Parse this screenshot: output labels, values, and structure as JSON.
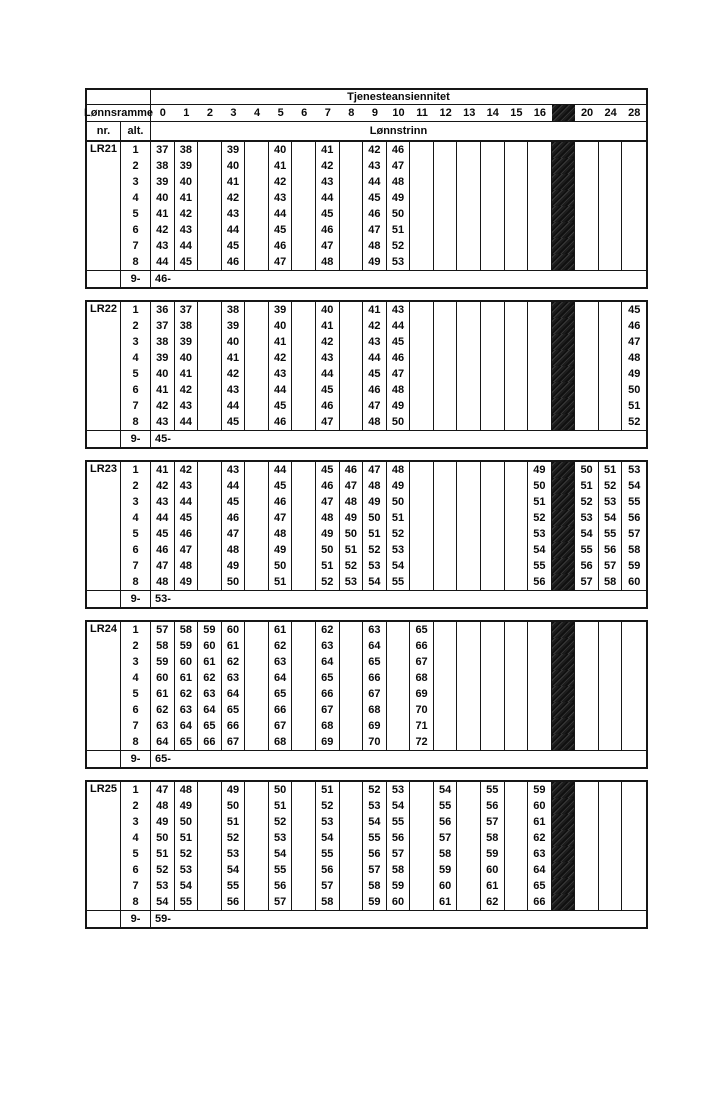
{
  "header": {
    "seniority_label": "Tjenesteansiennitet",
    "lonnsramme_label": "Lønnsramme",
    "nr_label": "nr.",
    "alt_label": "alt.",
    "lonnstrinn_label": "Lønnstrinn",
    "black_column_index": 17,
    "columns": [
      "0",
      "1",
      "2",
      "3",
      "4",
      "5",
      "6",
      "7",
      "8",
      "9",
      "10",
      "11",
      "12",
      "13",
      "14",
      "15",
      "16",
      "",
      "20",
      "24",
      "28"
    ]
  },
  "accent_colors": {
    "line": "#161616",
    "blocked_column_fill": "#1b1b1b",
    "paper": "#ffffff"
  },
  "blocks": [
    {
      "label": "LR21",
      "footer_alt": "9-",
      "footer_value": "46-",
      "rows": [
        {
          "alt": "1",
          "cells": [
            "37",
            "38",
            "",
            "39",
            "",
            "40",
            "",
            "41",
            "",
            "42",
            "46",
            "",
            "",
            "",
            "",
            "",
            "",
            "",
            "",
            "",
            ""
          ]
        },
        {
          "alt": "2",
          "cells": [
            "38",
            "39",
            "",
            "40",
            "",
            "41",
            "",
            "42",
            "",
            "43",
            "47",
            "",
            "",
            "",
            "",
            "",
            "",
            "",
            "",
            "",
            ""
          ]
        },
        {
          "alt": "3",
          "cells": [
            "39",
            "40",
            "",
            "41",
            "",
            "42",
            "",
            "43",
            "",
            "44",
            "48",
            "",
            "",
            "",
            "",
            "",
            "",
            "",
            "",
            "",
            ""
          ]
        },
        {
          "alt": "4",
          "cells": [
            "40",
            "41",
            "",
            "42",
            "",
            "43",
            "",
            "44",
            "",
            "45",
            "49",
            "",
            "",
            "",
            "",
            "",
            "",
            "",
            "",
            "",
            ""
          ]
        },
        {
          "alt": "5",
          "cells": [
            "41",
            "42",
            "",
            "43",
            "",
            "44",
            "",
            "45",
            "",
            "46",
            "50",
            "",
            "",
            "",
            "",
            "",
            "",
            "",
            "",
            "",
            ""
          ]
        },
        {
          "alt": "6",
          "cells": [
            "42",
            "43",
            "",
            "44",
            "",
            "45",
            "",
            "46",
            "",
            "47",
            "51",
            "",
            "",
            "",
            "",
            "",
            "",
            "",
            "",
            "",
            ""
          ]
        },
        {
          "alt": "7",
          "cells": [
            "43",
            "44",
            "",
            "45",
            "",
            "46",
            "",
            "47",
            "",
            "48",
            "52",
            "",
            "",
            "",
            "",
            "",
            "",
            "",
            "",
            "",
            ""
          ]
        },
        {
          "alt": "8",
          "cells": [
            "44",
            "45",
            "",
            "46",
            "",
            "47",
            "",
            "48",
            "",
            "49",
            "53",
            "",
            "",
            "",
            "",
            "",
            "",
            "",
            "",
            "",
            ""
          ]
        }
      ]
    },
    {
      "label": "LR22",
      "footer_alt": "9-",
      "footer_value": "45-",
      "rows": [
        {
          "alt": "1",
          "cells": [
            "36",
            "37",
            "",
            "38",
            "",
            "39",
            "",
            "40",
            "",
            "41",
            "43",
            "",
            "",
            "",
            "",
            "",
            "",
            "",
            "",
            "",
            "45"
          ]
        },
        {
          "alt": "2",
          "cells": [
            "37",
            "38",
            "",
            "39",
            "",
            "40",
            "",
            "41",
            "",
            "42",
            "44",
            "",
            "",
            "",
            "",
            "",
            "",
            "",
            "",
            "",
            "46"
          ]
        },
        {
          "alt": "3",
          "cells": [
            "38",
            "39",
            "",
            "40",
            "",
            "41",
            "",
            "42",
            "",
            "43",
            "45",
            "",
            "",
            "",
            "",
            "",
            "",
            "",
            "",
            "",
            "47"
          ]
        },
        {
          "alt": "4",
          "cells": [
            "39",
            "40",
            "",
            "41",
            "",
            "42",
            "",
            "43",
            "",
            "44",
            "46",
            "",
            "",
            "",
            "",
            "",
            "",
            "",
            "",
            "",
            "48"
          ]
        },
        {
          "alt": "5",
          "cells": [
            "40",
            "41",
            "",
            "42",
            "",
            "43",
            "",
            "44",
            "",
            "45",
            "47",
            "",
            "",
            "",
            "",
            "",
            "",
            "",
            "",
            "",
            "49"
          ]
        },
        {
          "alt": "6",
          "cells": [
            "41",
            "42",
            "",
            "43",
            "",
            "44",
            "",
            "45",
            "",
            "46",
            "48",
            "",
            "",
            "",
            "",
            "",
            "",
            "",
            "",
            "",
            "50"
          ]
        },
        {
          "alt": "7",
          "cells": [
            "42",
            "43",
            "",
            "44",
            "",
            "45",
            "",
            "46",
            "",
            "47",
            "49",
            "",
            "",
            "",
            "",
            "",
            "",
            "",
            "",
            "",
            "51"
          ]
        },
        {
          "alt": "8",
          "cells": [
            "43",
            "44",
            "",
            "45",
            "",
            "46",
            "",
            "47",
            "",
            "48",
            "50",
            "",
            "",
            "",
            "",
            "",
            "",
            "",
            "",
            "",
            "52"
          ]
        }
      ]
    },
    {
      "label": "LR23",
      "footer_alt": "9-",
      "footer_value": "53-",
      "rows": [
        {
          "alt": "1",
          "cells": [
            "41",
            "42",
            "",
            "43",
            "",
            "44",
            "",
            "45",
            "46",
            "47",
            "48",
            "",
            "",
            "",
            "",
            "",
            "49",
            "",
            "50",
            "51",
            "53"
          ]
        },
        {
          "alt": "2",
          "cells": [
            "42",
            "43",
            "",
            "44",
            "",
            "45",
            "",
            "46",
            "47",
            "48",
            "49",
            "",
            "",
            "",
            "",
            "",
            "50",
            "",
            "51",
            "52",
            "54"
          ]
        },
        {
          "alt": "3",
          "cells": [
            "43",
            "44",
            "",
            "45",
            "",
            "46",
            "",
            "47",
            "48",
            "49",
            "50",
            "",
            "",
            "",
            "",
            "",
            "51",
            "",
            "52",
            "53",
            "55"
          ]
        },
        {
          "alt": "4",
          "cells": [
            "44",
            "45",
            "",
            "46",
            "",
            "47",
            "",
            "48",
            "49",
            "50",
            "51",
            "",
            "",
            "",
            "",
            "",
            "52",
            "",
            "53",
            "54",
            "56"
          ]
        },
        {
          "alt": "5",
          "cells": [
            "45",
            "46",
            "",
            "47",
            "",
            "48",
            "",
            "49",
            "50",
            "51",
            "52",
            "",
            "",
            "",
            "",
            "",
            "53",
            "",
            "54",
            "55",
            "57"
          ]
        },
        {
          "alt": "6",
          "cells": [
            "46",
            "47",
            "",
            "48",
            "",
            "49",
            "",
            "50",
            "51",
            "52",
            "53",
            "",
            "",
            "",
            "",
            "",
            "54",
            "",
            "55",
            "56",
            "58"
          ]
        },
        {
          "alt": "7",
          "cells": [
            "47",
            "48",
            "",
            "49",
            "",
            "50",
            "",
            "51",
            "52",
            "53",
            "54",
            "",
            "",
            "",
            "",
            "",
            "55",
            "",
            "56",
            "57",
            "59"
          ]
        },
        {
          "alt": "8",
          "cells": [
            "48",
            "49",
            "",
            "50",
            "",
            "51",
            "",
            "52",
            "53",
            "54",
            "55",
            "",
            "",
            "",
            "",
            "",
            "56",
            "",
            "57",
            "58",
            "60"
          ]
        }
      ]
    },
    {
      "label": "LR24",
      "footer_alt": "9-",
      "footer_value": "65-",
      "rows": [
        {
          "alt": "1",
          "cells": [
            "57",
            "58",
            "59",
            "60",
            "",
            "61",
            "",
            "62",
            "",
            "63",
            "",
            "65",
            "",
            "",
            "",
            "",
            "",
            "",
            "",
            "",
            ""
          ]
        },
        {
          "alt": "2",
          "cells": [
            "58",
            "59",
            "60",
            "61",
            "",
            "62",
            "",
            "63",
            "",
            "64",
            "",
            "66",
            "",
            "",
            "",
            "",
            "",
            "",
            "",
            "",
            ""
          ]
        },
        {
          "alt": "3",
          "cells": [
            "59",
            "60",
            "61",
            "62",
            "",
            "63",
            "",
            "64",
            "",
            "65",
            "",
            "67",
            "",
            "",
            "",
            "",
            "",
            "",
            "",
            "",
            ""
          ]
        },
        {
          "alt": "4",
          "cells": [
            "60",
            "61",
            "62",
            "63",
            "",
            "64",
            "",
            "65",
            "",
            "66",
            "",
            "68",
            "",
            "",
            "",
            "",
            "",
            "",
            "",
            "",
            ""
          ]
        },
        {
          "alt": "5",
          "cells": [
            "61",
            "62",
            "63",
            "64",
            "",
            "65",
            "",
            "66",
            "",
            "67",
            "",
            "69",
            "",
            "",
            "",
            "",
            "",
            "",
            "",
            "",
            ""
          ]
        },
        {
          "alt": "6",
          "cells": [
            "62",
            "63",
            "64",
            "65",
            "",
            "66",
            "",
            "67",
            "",
            "68",
            "",
            "70",
            "",
            "",
            "",
            "",
            "",
            "",
            "",
            "",
            ""
          ]
        },
        {
          "alt": "7",
          "cells": [
            "63",
            "64",
            "65",
            "66",
            "",
            "67",
            "",
            "68",
            "",
            "69",
            "",
            "71",
            "",
            "",
            "",
            "",
            "",
            "",
            "",
            "",
            ""
          ]
        },
        {
          "alt": "8",
          "cells": [
            "64",
            "65",
            "66",
            "67",
            "",
            "68",
            "",
            "69",
            "",
            "70",
            "",
            "72",
            "",
            "",
            "",
            "",
            "",
            "",
            "",
            "",
            ""
          ]
        }
      ]
    },
    {
      "label": "LR25",
      "footer_alt": "9-",
      "footer_value": "59-",
      "rows": [
        {
          "alt": "1",
          "cells": [
            "47",
            "48",
            "",
            "49",
            "",
            "50",
            "",
            "51",
            "",
            "52",
            "53",
            "",
            "54",
            "",
            "55",
            "",
            "59",
            "",
            "",
            "",
            ""
          ]
        },
        {
          "alt": "2",
          "cells": [
            "48",
            "49",
            "",
            "50",
            "",
            "51",
            "",
            "52",
            "",
            "53",
            "54",
            "",
            "55",
            "",
            "56",
            "",
            "60",
            "",
            "",
            "",
            ""
          ]
        },
        {
          "alt": "3",
          "cells": [
            "49",
            "50",
            "",
            "51",
            "",
            "52",
            "",
            "53",
            "",
            "54",
            "55",
            "",
            "56",
            "",
            "57",
            "",
            "61",
            "",
            "",
            "",
            ""
          ]
        },
        {
          "alt": "4",
          "cells": [
            "50",
            "51",
            "",
            "52",
            "",
            "53",
            "",
            "54",
            "",
            "55",
            "56",
            "",
            "57",
            "",
            "58",
            "",
            "62",
            "",
            "",
            "",
            ""
          ]
        },
        {
          "alt": "5",
          "cells": [
            "51",
            "52",
            "",
            "53",
            "",
            "54",
            "",
            "55",
            "",
            "56",
            "57",
            "",
            "58",
            "",
            "59",
            "",
            "63",
            "",
            "",
            "",
            ""
          ]
        },
        {
          "alt": "6",
          "cells": [
            "52",
            "53",
            "",
            "54",
            "",
            "55",
            "",
            "56",
            "",
            "57",
            "58",
            "",
            "59",
            "",
            "60",
            "",
            "64",
            "",
            "",
            "",
            ""
          ]
        },
        {
          "alt": "7",
          "cells": [
            "53",
            "54",
            "",
            "55",
            "",
            "56",
            "",
            "57",
            "",
            "58",
            "59",
            "",
            "60",
            "",
            "61",
            "",
            "65",
            "",
            "",
            "",
            ""
          ]
        },
        {
          "alt": "8",
          "cells": [
            "54",
            "55",
            "",
            "56",
            "",
            "57",
            "",
            "58",
            "",
            "59",
            "60",
            "",
            "61",
            "",
            "62",
            "",
            "66",
            "",
            "",
            "",
            ""
          ]
        }
      ]
    }
  ]
}
